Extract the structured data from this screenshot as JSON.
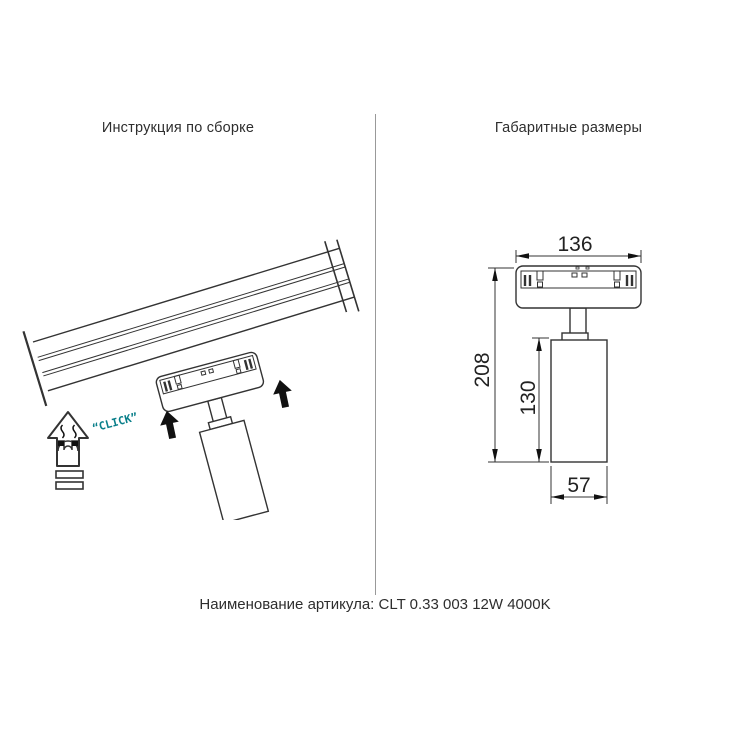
{
  "header": {
    "left_title": "Инструкция по сборке",
    "right_title": "Габаритные размеры"
  },
  "assembly": {
    "click_label": "“CLICK”"
  },
  "dimensions": {
    "adapter_width": "136",
    "total_height": "208",
    "body_height": "130",
    "body_diameter": "57"
  },
  "footer": {
    "article_label": "Наименование артикула:",
    "article_value": "CLT 0.33 003 12W 4000K"
  },
  "icons": {
    "magnet_arrow": "magnet-insert-up-arrow",
    "direction_arrow": "up-arrow"
  },
  "colors": {
    "line": "#333333",
    "click_accent": "#0a7f8a",
    "arrow_fill": "#111111",
    "divider": "#999999",
    "background": "#ffffff"
  }
}
